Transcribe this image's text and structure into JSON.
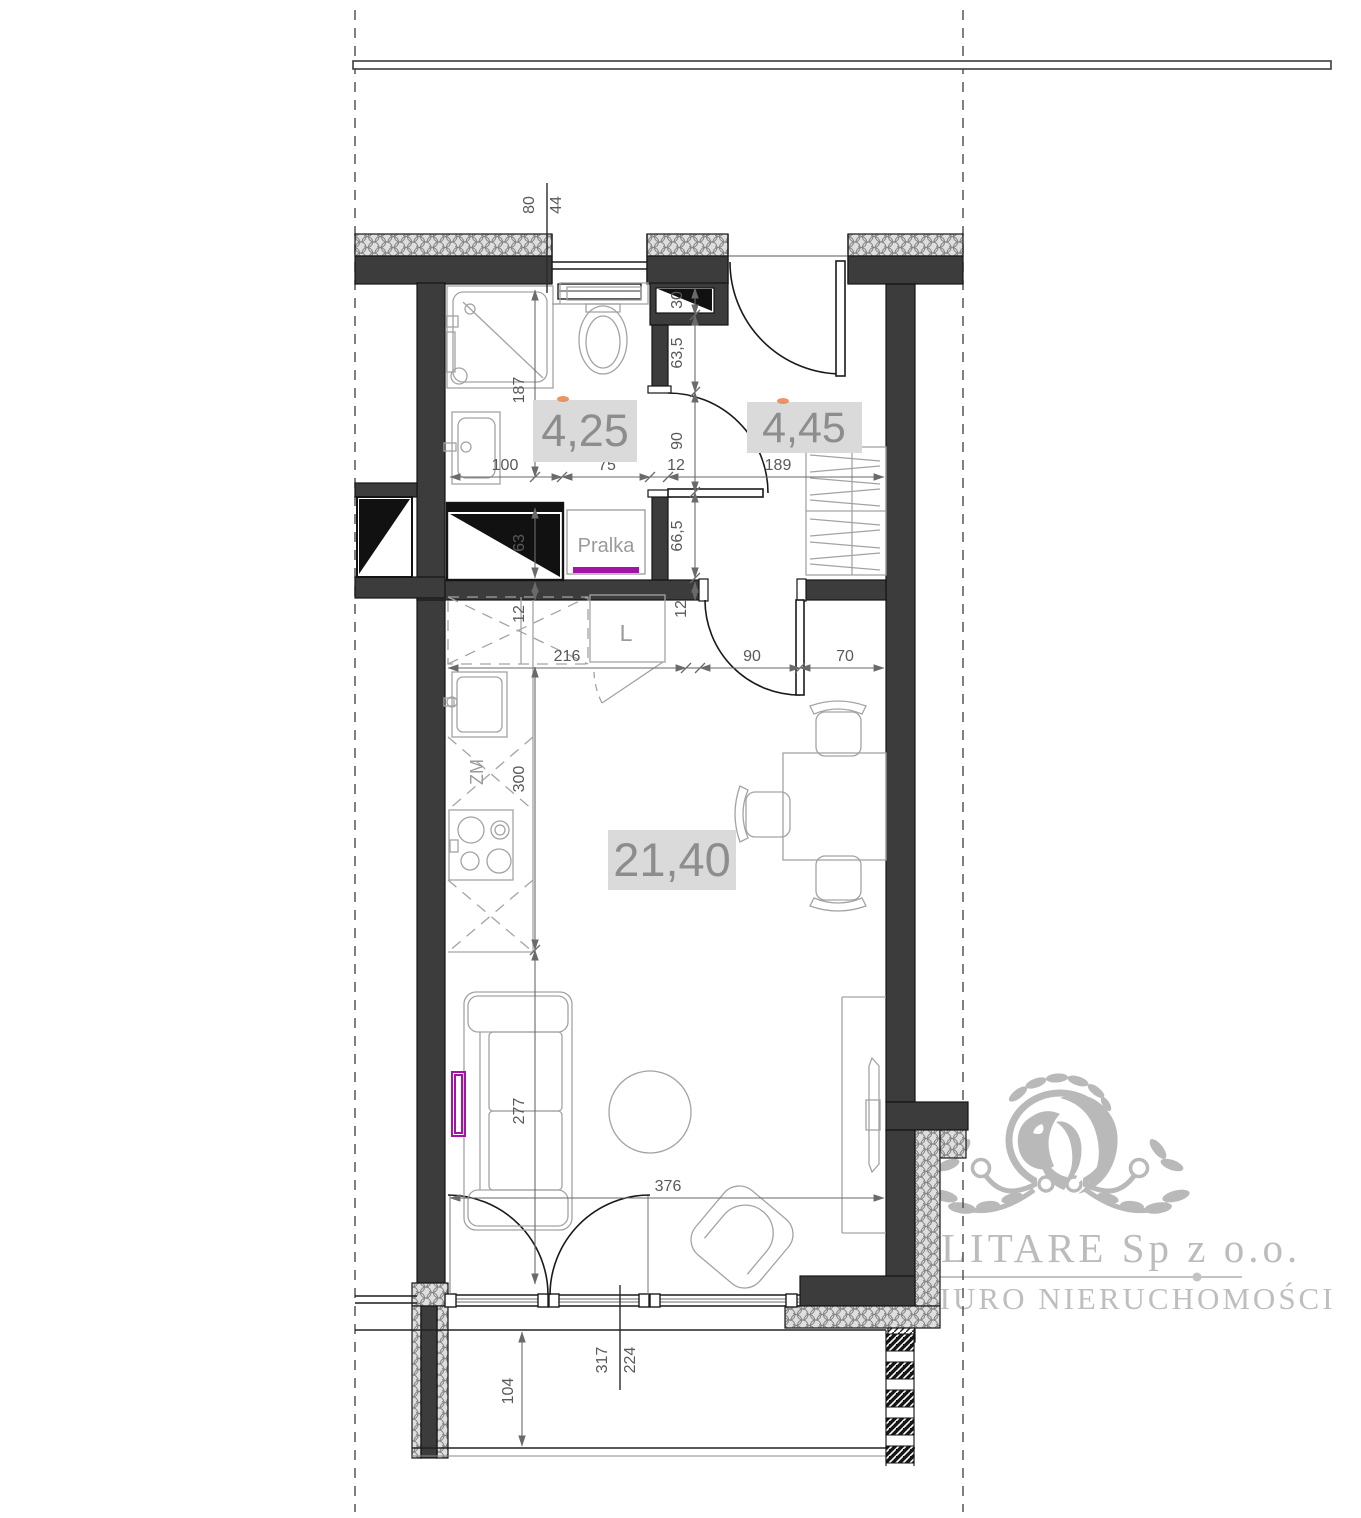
{
  "title": "apartment-floor-plan",
  "rooms": {
    "bathroom": {
      "area": "4,25"
    },
    "hall": {
      "area": "4,45"
    },
    "living": {
      "area": "21,40"
    }
  },
  "labels": {
    "washer": "Pralka",
    "fridge": "L",
    "dishwasher": "ZM"
  },
  "dims": {
    "top_window_w": "80",
    "top_window_h": "44",
    "shaft_top": "30",
    "hall_top": "63,5",
    "bath_door": "90",
    "hall_mid": "66,5",
    "hall_wall": "12",
    "bath_depth": "187",
    "shaft_h": "63",
    "kitchen_wall": "12",
    "bath_sink": "100",
    "bath_wc": "75",
    "bath_wall": "12",
    "hall_width": "189",
    "kitchen_run": "216",
    "living_door": "90",
    "living_east": "70",
    "kitchen_depth": "300",
    "sofa_run": "277",
    "balcony_door": "376",
    "balcony_depth": "104",
    "balcony_win_w": "317",
    "balcony_win_h": "224"
  },
  "watermark": {
    "company": "LITARE Sp z o.o.",
    "tagline": "BIURO NIERUCHOMOŚCI"
  },
  "colors": {
    "wall": "#3c3c3c",
    "furniture_line": "#a3a3a3",
    "dimension": "#6a6a6a",
    "area_box": "#dadada",
    "area_text": "#8d8d8d",
    "accent_purple": "#a313a8",
    "watermark_gray": "#b5b5b5"
  }
}
